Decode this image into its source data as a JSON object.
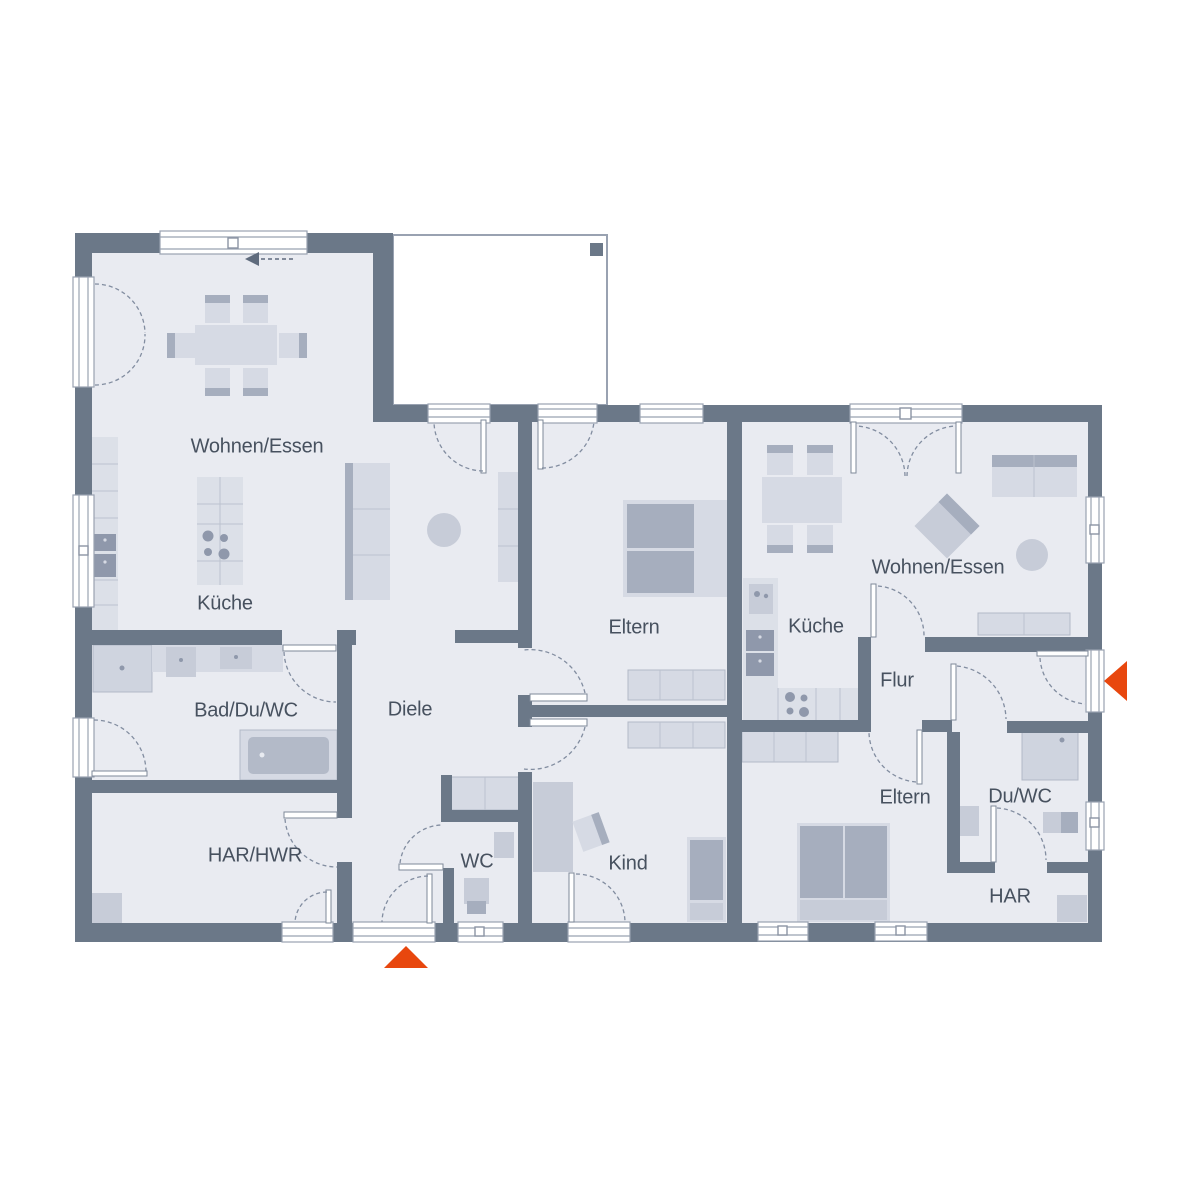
{
  "plan_type": "floor-plan",
  "colors": {
    "wall": "#6b7888",
    "floor": "#e9ebf1",
    "furniture_light": "#d6dae4",
    "furniture_mid": "#c7ccd8",
    "furniture_dark": "#a6aebe",
    "appliance_dark": "#8f98ab",
    "outline": "#99a2b1",
    "text": "#47515f",
    "accent_orange": "#e8470e"
  },
  "units": {
    "left": {
      "name": "left-unit",
      "rooms": [
        {
          "label": "Wohnen/Essen"
        },
        {
          "label": "Küche"
        },
        {
          "label": "Bad/Du/WC"
        },
        {
          "label": "Diele"
        },
        {
          "label": "HAR/HWR"
        },
        {
          "label": "WC"
        },
        {
          "label": "Eltern"
        },
        {
          "label": "Kind"
        }
      ]
    },
    "right": {
      "name": "right-unit",
      "rooms": [
        {
          "label": "Wohnen/Essen"
        },
        {
          "label": "Küche"
        },
        {
          "label": "Flur"
        },
        {
          "label": "Eltern"
        },
        {
          "label": "Du/WC"
        },
        {
          "label": "HAR"
        }
      ]
    }
  },
  "icons": [
    {
      "name": "entrance-arrow-south",
      "shape": "triangle-up",
      "color": "#e8470e"
    },
    {
      "name": "entrance-arrow-east",
      "shape": "triangle-left",
      "color": "#e8470e"
    },
    {
      "name": "sliding-door-direction-arrow",
      "shape": "dashed-arrow-left",
      "color": "#5f6b7d"
    },
    {
      "name": "terrace-column",
      "shape": "square",
      "color": "#6b7888"
    }
  ]
}
